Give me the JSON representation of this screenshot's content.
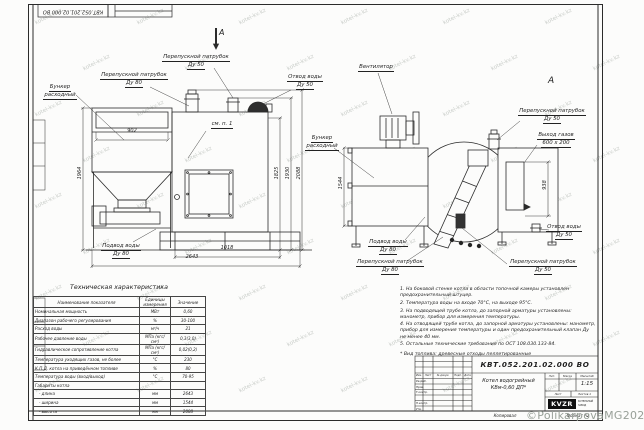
{
  "doc_number": "КВТ.052.201.02.000  ВО",
  "section_mark": "А",
  "view_mark": "А",
  "callouts": [
    [
      "Бункер",
      "расходный"
    ],
    [
      "Перепускной патрубок",
      "Ду 80"
    ],
    [
      "Перепускной патрубок",
      "Ду 50"
    ],
    [
      "Отвод воды",
      "Ду 50"
    ],
    [
      "см. п. 1"
    ],
    [
      "Подвод воды",
      "Ду 80"
    ],
    [
      "Вентилятор"
    ],
    [
      "Бункер",
      "расходный"
    ],
    [
      "Перепускной патрубок",
      "Ду 50"
    ],
    [
      "Выход газов",
      "600 x 200"
    ],
    [
      "Отвод воды",
      "Ду 50"
    ],
    [
      "Перепускной патрубок",
      "Ду 50"
    ],
    [
      "Подвод воды",
      "Ду 80"
    ],
    [
      "Перепускной патрубок",
      "Ду 80"
    ]
  ],
  "dimensions": [
    "902",
    "1964",
    "1018",
    "2643",
    "1825",
    "1930",
    "2088",
    "1544",
    "938"
  ],
  "tech_table": {
    "title": "Техническая характеристика",
    "headers": [
      "Наименование показателя",
      "Единицы измерения",
      "Значение"
    ],
    "rows": [
      [
        "Номинальная мощность",
        "МВт",
        "0,60"
      ],
      [
        "Диапазон рабочего регулирования",
        "%",
        "30-100"
      ],
      [
        "Расход воды",
        "м³/ч",
        "21"
      ],
      [
        "Рабочее давление воды",
        "МПа (кгс/см²)",
        "0,3(3,0)"
      ],
      [
        "Гидравлическое сопротивление котла",
        "МПа (кгс/см²)",
        "0,02(0,2)"
      ],
      [
        "Температура уходящих газов, не более",
        "°С",
        "230"
      ],
      [
        "К.П.Д. котла на приведённом топливе",
        "%",
        "80"
      ],
      [
        "Температура воды (вход/выход)",
        "°С",
        "70-95"
      ],
      [
        "Габариты котла",
        "",
        ""
      ],
      [
        "   - длина",
        "мм",
        "2643"
      ],
      [
        "   - ширина",
        "мм",
        "1544"
      ],
      [
        "   - высота",
        "мм",
        "2088"
      ]
    ]
  },
  "notes": [
    "1. На боковой стенке котла в области топочной камеры установлен предохранительный штуцер.",
    "2. Температура воды на входе 70°С, на выходе 95°С.",
    "3. На подводящей трубе котла, до запорной арматуры установлены: манометр, прибор для измерения температуры.",
    "4. На отводящей трубе котла, до запорной арматуры установлены: манометр, прибор для измерения температуры и один предохранительный клапан Ду не менее 40 мм.",
    "5. Остальные технические требования по ОСТ 108.030.133-84.",
    "* Вид топлива: древесные отходы пеллетированные"
  ],
  "title_block": {
    "product_line1": "Котел водогрейный",
    "product_line2": "КВм-0,60   ДП*",
    "lit": "Лит.",
    "mass": "Масса",
    "scale_label": "Масштаб",
    "scale": "1:15",
    "sheet": "Лист",
    "sheets": "Листов 1",
    "cols": [
      "Изм.",
      "Лист",
      "№ докум.",
      "Подп.",
      "Дата"
    ],
    "roles": [
      "Разраб.",
      "Пров.",
      "Т.контр.",
      "Н.контр.",
      "Утв."
    ],
    "logo": "KVZR",
    "logo_caption": [
      "КОТЕЛЬНЫЙ",
      "ЗАВОД"
    ]
  },
  "footer": {
    "copied": "Копировал",
    "format": "Формат А2"
  },
  "watermarks": {
    "tile": "kotel-kv.kz",
    "copyright": "©PolikarpovaMG2021"
  }
}
